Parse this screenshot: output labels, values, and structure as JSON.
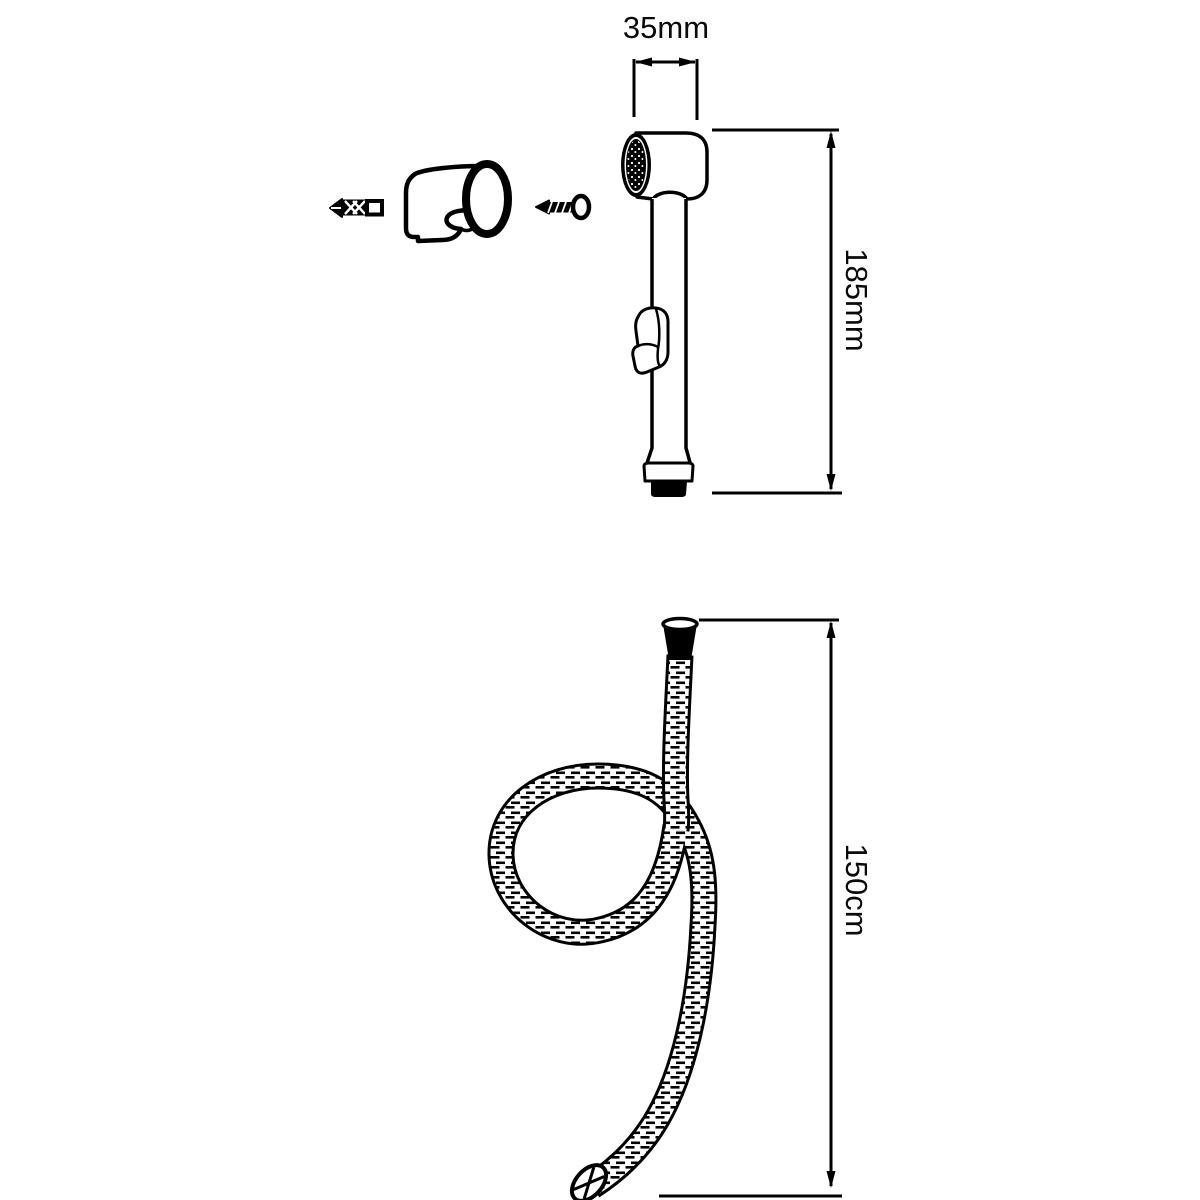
{
  "diagram": {
    "background_color": "#ffffff",
    "line_color": "#000000",
    "labels": {
      "head_width": "35mm",
      "handset_length": "185mm",
      "hose_length": "150cm"
    }
  }
}
